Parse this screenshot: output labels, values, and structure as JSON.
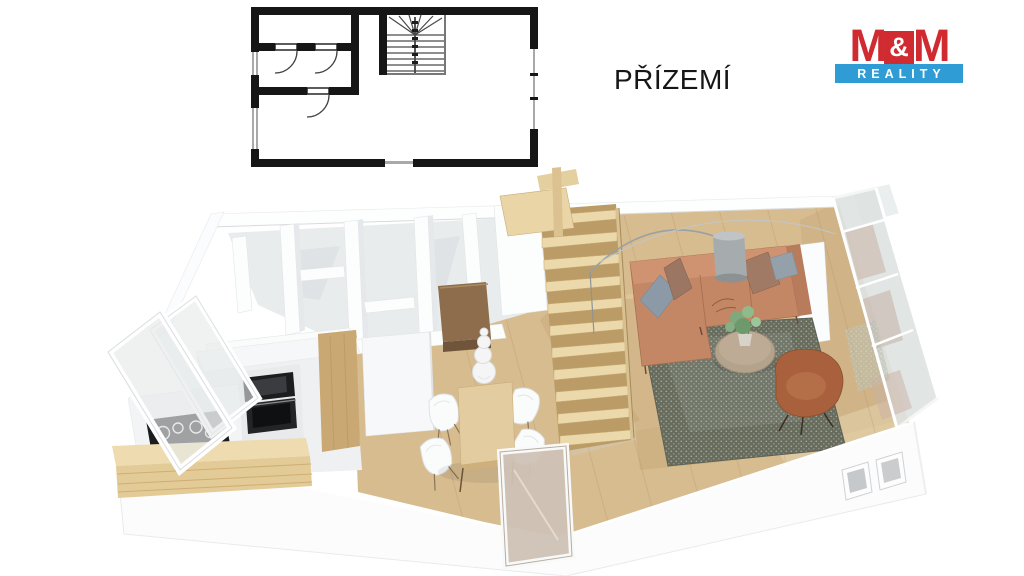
{
  "header": {
    "floor_label": "PŘÍZEMÍ"
  },
  "logo": {
    "m1": "M",
    "amp": "&",
    "m2": "M",
    "bottom": "REALITY",
    "colors": {
      "red": "#cf2b31",
      "blue": "#2f9cd5",
      "white": "#ffffff"
    }
  },
  "palette": {
    "plan_wall_black": "#161616",
    "plan_window_gray": "#a9a9a9",
    "wall_white": "#fcfdfd",
    "room_floor_gray": "#e9eced",
    "wood_floor": "#d7bc90",
    "stair_wood": "#ecd9ab",
    "walnut_wardrobe": "#8d6d4c",
    "sofa_tan": "#c38766",
    "pillow_blue": "#8b9aa6",
    "pillow_brown": "#9b7763",
    "armchair_rust": "#a8613c",
    "rug_dark": "#676c5f",
    "glass": "#dfe3e2",
    "appliance_black": "#1c1d1f"
  }
}
